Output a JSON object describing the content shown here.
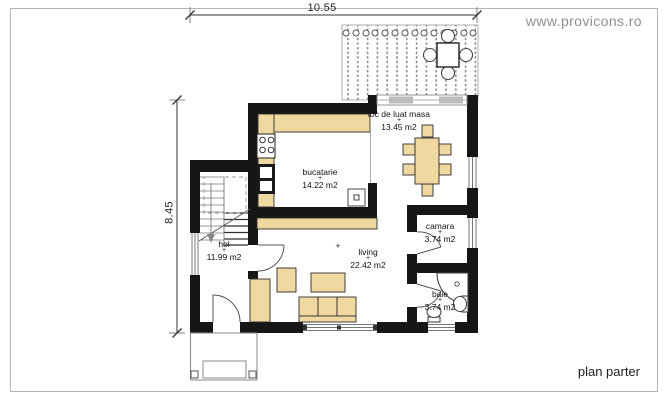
{
  "header": {
    "watermark": "www.provicons.ro"
  },
  "footer": {
    "plan_label": "plan parter"
  },
  "dimensions": {
    "top": "10.55",
    "left": "8.45"
  },
  "marks": {
    "level_marker": "+"
  },
  "rooms": {
    "bucatarie": {
      "name": "bucatarie",
      "area": "14.22 m2"
    },
    "loc_de_luat_masa": {
      "name": "loc de luat masa",
      "area": "13.45 m2"
    },
    "camara": {
      "name": "camara",
      "area": "3.74 m2"
    },
    "living": {
      "name": "living",
      "area": "22.42 m2"
    },
    "hol": {
      "name": "hol",
      "area": "11.99 m2"
    },
    "baie": {
      "name": "baie",
      "area": "3.74 m2"
    }
  },
  "colors": {
    "furniture": "#efd9a1",
    "wall": "#161616",
    "watermark": "#8f8f8f",
    "frame": "#b5b5b5"
  }
}
